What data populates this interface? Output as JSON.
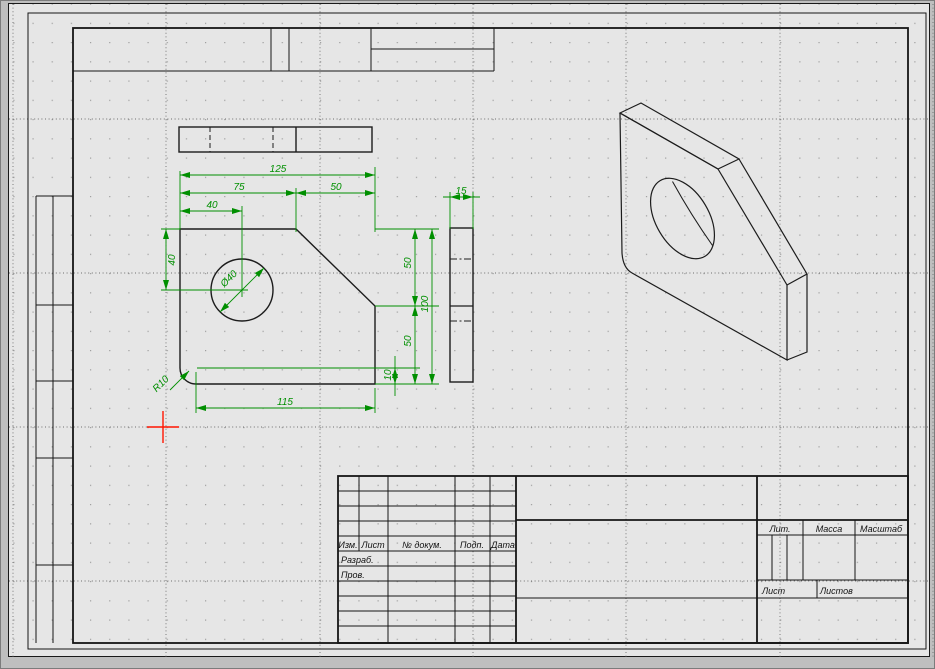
{
  "app": {
    "kind": "cad-drawing-canvas"
  },
  "colors": {
    "dimension_green": "#008f00",
    "cursor_red": "#ff1500",
    "line_black": "#1c1c1c",
    "canvas_bg": "#e6e6e6",
    "chrome_bg": "#bfbfbf"
  },
  "dimensions": {
    "total_width": "125",
    "left_width": "75",
    "chamfer_width": "50",
    "hole_x": "40",
    "hole_y": "40",
    "hole_diameter": "Ø40",
    "total_height": "100",
    "upper_height": "50",
    "lower_height": "50",
    "bottom_offset": "10",
    "bottom_width": "115",
    "corner_radius": "R10",
    "thickness": "15"
  },
  "title_block": {
    "izm": "Изм.",
    "list": "Лист",
    "doc_no": "№ докум.",
    "podp": "Подп.",
    "date": "Дата",
    "razrab": "Разраб.",
    "prov": "Пров.",
    "lit": "Лит.",
    "massa": "Масса",
    "masshtab": "Масштаб",
    "sheet": "Лист",
    "sheets": "Листов"
  }
}
